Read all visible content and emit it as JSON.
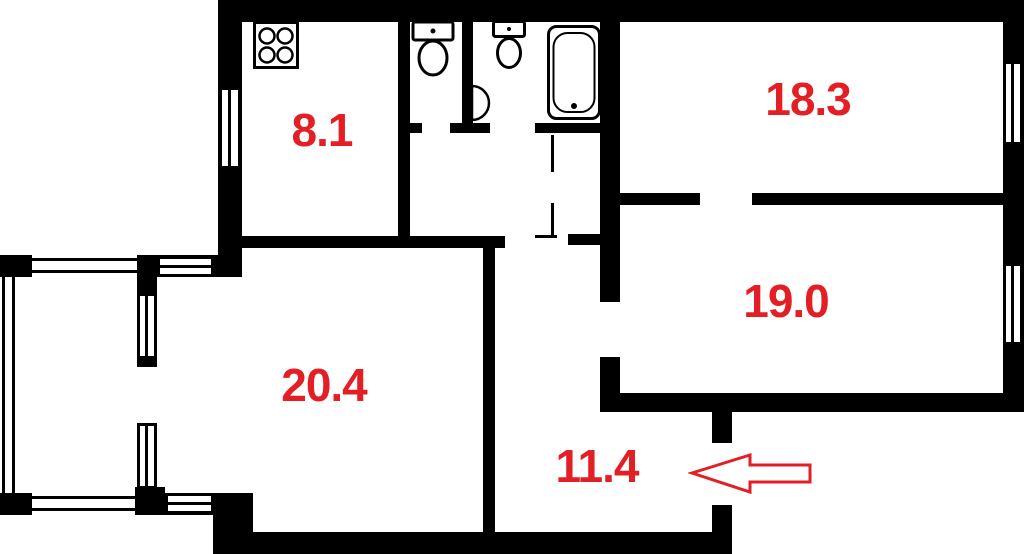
{
  "plan": {
    "background_color": "#ffffff",
    "wall_color": "#000000",
    "label_color": "#e31e24",
    "room_labels": [
      {
        "id": "kitchen",
        "area": "8.1"
      },
      {
        "id": "room-top-right",
        "area": "18.3"
      },
      {
        "id": "room-right",
        "area": "19.0"
      },
      {
        "id": "room-left",
        "area": "20.4"
      },
      {
        "id": "hallway",
        "area": "11.4"
      }
    ],
    "fixtures": [
      {
        "icon": "stove-icon"
      },
      {
        "icon": "toilet-icon"
      },
      {
        "icon": "toilet-icon"
      },
      {
        "icon": "sink-icon"
      },
      {
        "icon": "bathtub-icon"
      }
    ],
    "entrance_arrow": {
      "icon": "entrance-arrow-icon",
      "direction": "left"
    }
  }
}
